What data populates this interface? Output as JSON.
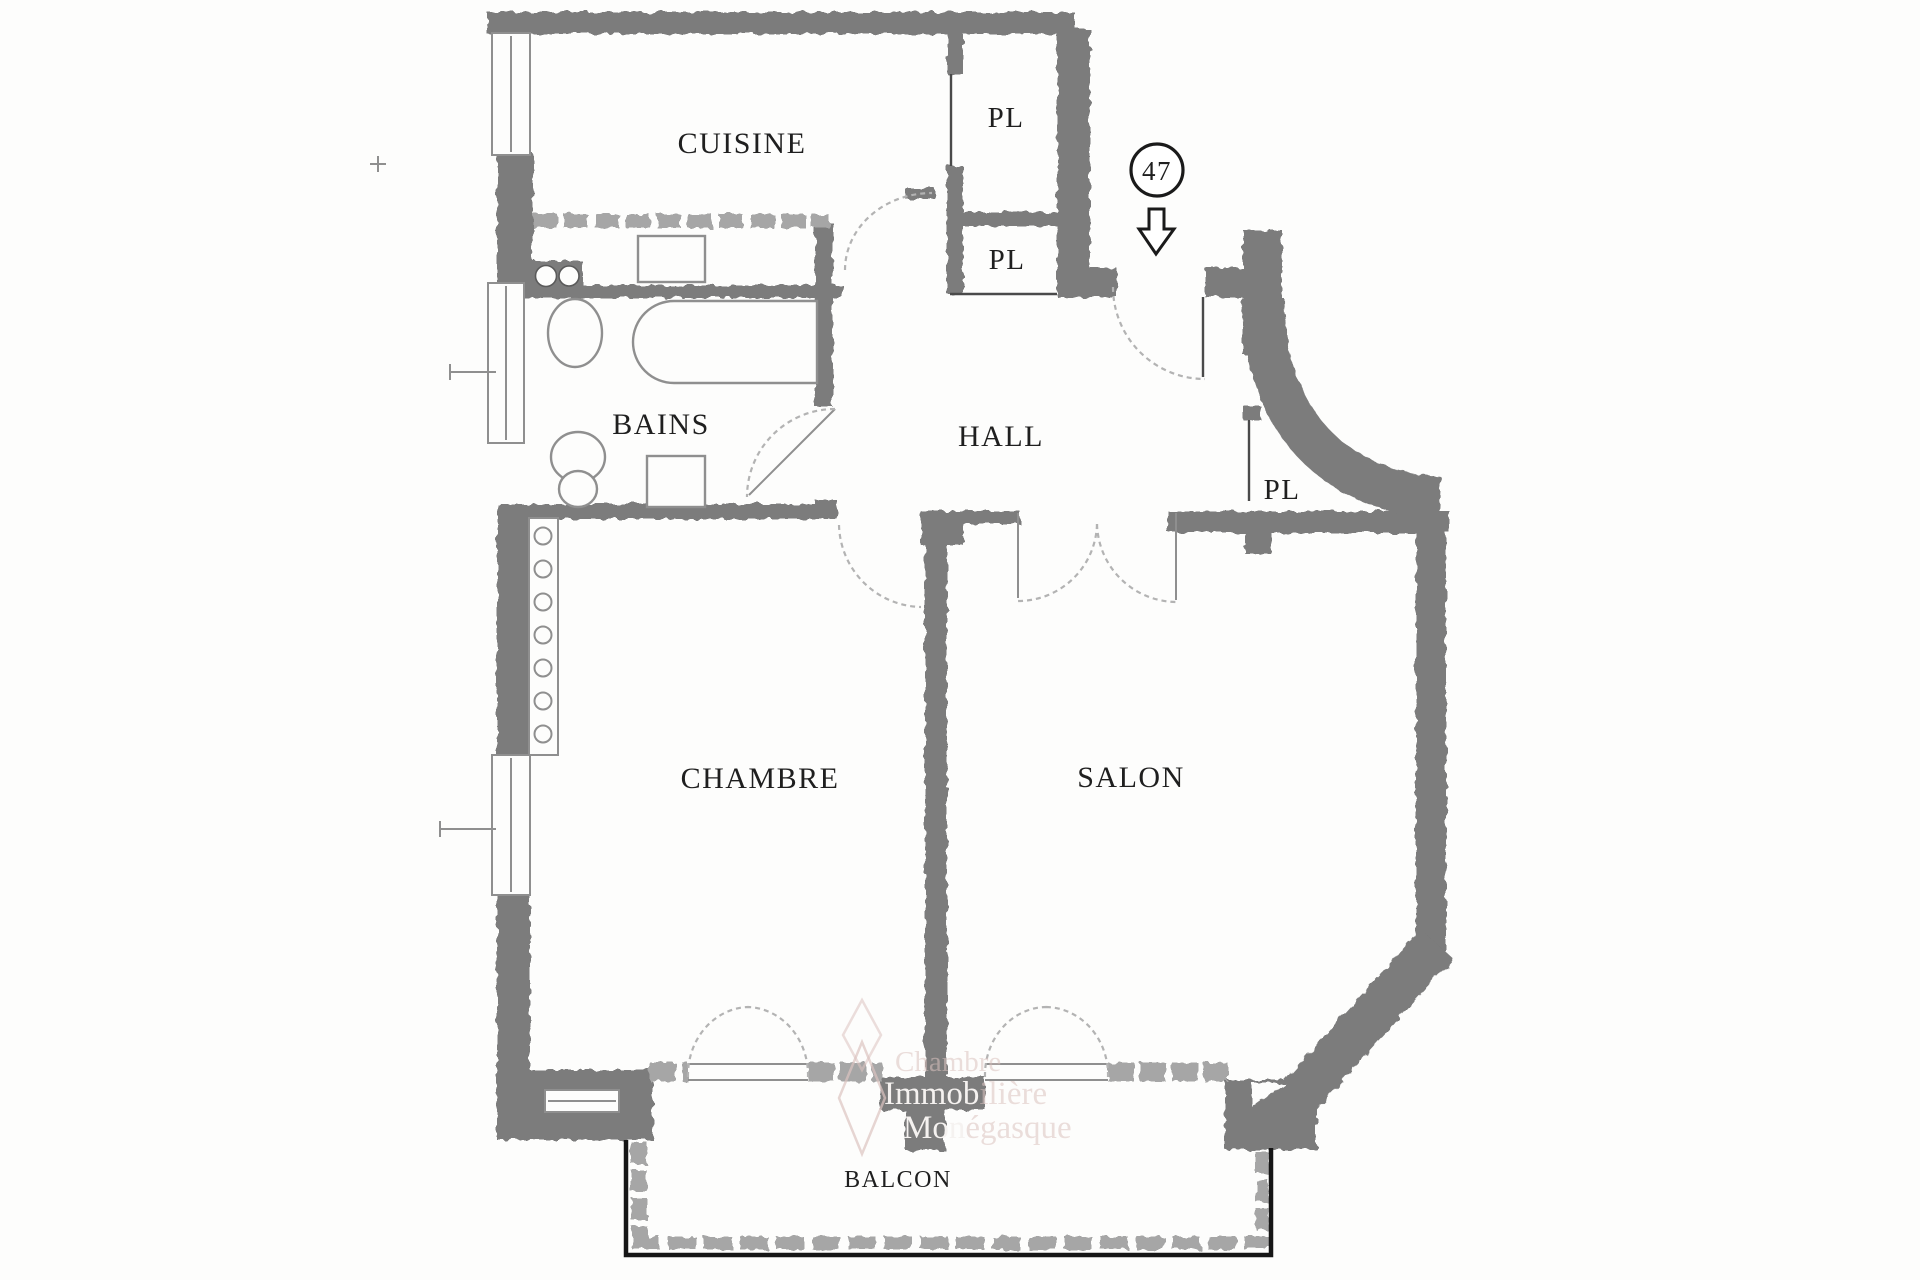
{
  "plan": {
    "unit_number": "47",
    "rooms": [
      {
        "id": "cuisine",
        "label": "CUISINE"
      },
      {
        "id": "pl-top",
        "label": "PL"
      },
      {
        "id": "pl-mid",
        "label": "PL"
      },
      {
        "id": "bains",
        "label": "BAINS"
      },
      {
        "id": "hall",
        "label": "HALL"
      },
      {
        "id": "pl-hall",
        "label": "PL"
      },
      {
        "id": "chambre",
        "label": "CHAMBRE"
      },
      {
        "id": "salon",
        "label": "SALON"
      },
      {
        "id": "balcon",
        "label": "BALCON"
      }
    ],
    "watermark": {
      "line1": "Chambre",
      "line2_knockout": "Immob",
      "line2_faint": "ilière",
      "line3_knockout": "Mon",
      "line3_faint": "égasque"
    },
    "colors": {
      "paper": "#fdfdfc",
      "wall": "#7b7b7b",
      "wall_light": "#a6a6a6",
      "ink": "#1f1f1f",
      "watermark": "#dcc3c0"
    }
  }
}
